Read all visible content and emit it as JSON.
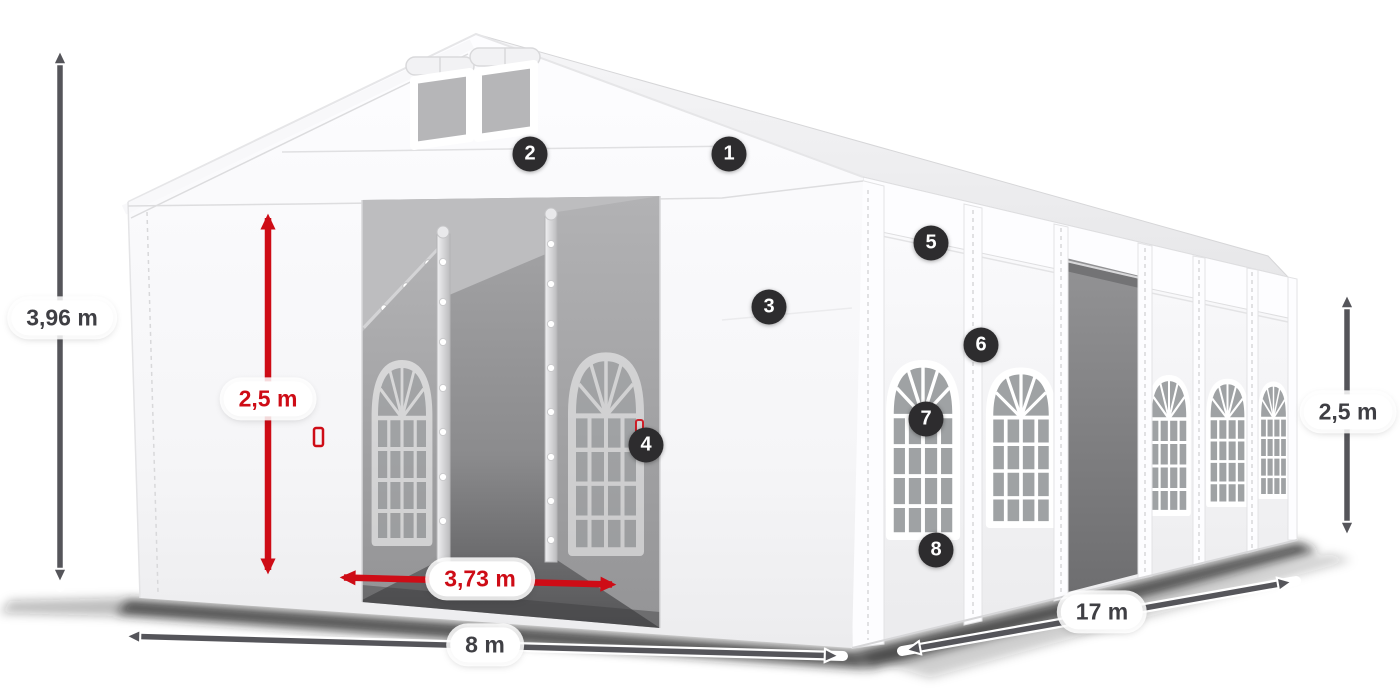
{
  "diagram": {
    "subject": "party-tent-dimension-diagram",
    "labels": {
      "total_height": "3,96 m",
      "entrance_height": "2,5 m",
      "entrance_width": "3,73 m",
      "front_width": "8 m",
      "side_length": "17 m",
      "side_wall_height": "2,5 m"
    },
    "callouts": [
      {
        "number": "1"
      },
      {
        "number": "2"
      },
      {
        "number": "3"
      },
      {
        "number": "4"
      },
      {
        "number": "5"
      },
      {
        "number": "6"
      },
      {
        "number": "7"
      },
      {
        "number": "8"
      }
    ],
    "colors": {
      "dimension_red": "#ce0c16",
      "dimension_dark": "#55555a",
      "callout_bg": "#2d2c2e"
    }
  }
}
